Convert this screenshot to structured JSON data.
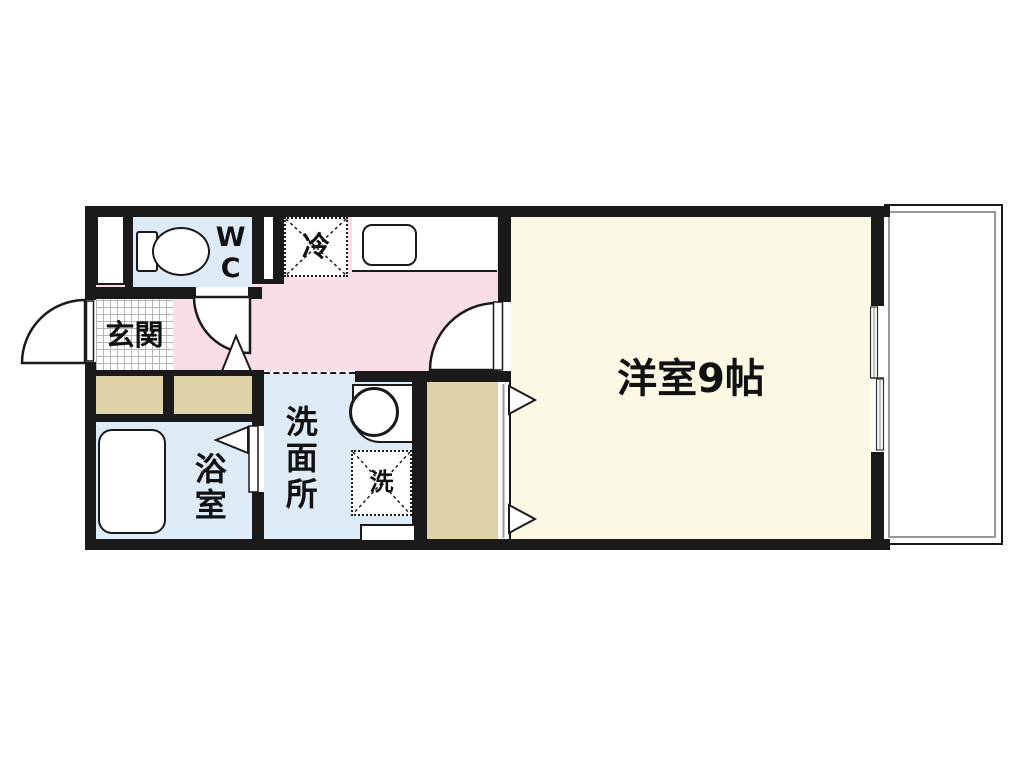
{
  "floorplan": {
    "type": "apartment-floor-plan",
    "rooms": {
      "entrance": {
        "label": "玄関"
      },
      "wc": {
        "label": "WC"
      },
      "refrigerator_space": {
        "label": "冷"
      },
      "bathroom": {
        "label": "浴室"
      },
      "washroom": {
        "label": "洗面所"
      },
      "washing_machine_space": {
        "label": "洗"
      },
      "western_room": {
        "label": "洋室9帖",
        "size_tatami": 9
      }
    },
    "fixtures": [
      "toilet-icon",
      "kitchen-sink-icon",
      "bathtub-icon",
      "washbasin-icon",
      "sliding-window",
      "balcony",
      "closet",
      "door-swing-arcs"
    ],
    "colors": {
      "wall": "#1a1a1a",
      "hallway_kitchen": "#f9dee8",
      "wet_area": "#dcebf6",
      "western_room": "#fbf8e3",
      "closet_storage": "#ded2a8",
      "tile_grid_line": "#b5b5b5",
      "balcony_inner_line": "#999999",
      "background": "#ffffff"
    }
  }
}
